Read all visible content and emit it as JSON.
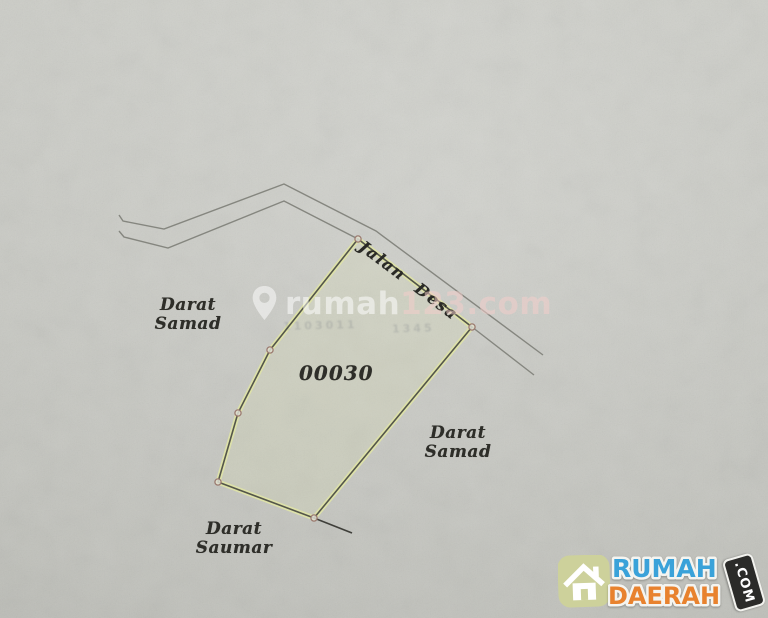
{
  "map": {
    "parcel_number": "00030",
    "road_label": "Jalan Desa",
    "area_labels": {
      "west": {
        "line1": "Darat",
        "line2": "Samad"
      },
      "east": {
        "line1": "Darat",
        "line2": "Samad"
      },
      "south": {
        "line1": "Darat",
        "line2": "Saumar"
      }
    },
    "geometry": {
      "parcel": [
        [
          358,
          239
        ],
        [
          472,
          327
        ],
        [
          314,
          518
        ],
        [
          218,
          482
        ],
        [
          238,
          413
        ],
        [
          270,
          350
        ]
      ],
      "road_upper": [
        [
          119,
          215
        ],
        [
          123,
          221
        ],
        [
          164,
          229
        ],
        [
          284,
          184
        ],
        [
          376,
          231
        ],
        [
          543,
          355
        ]
      ],
      "road_lower": [
        [
          119,
          231
        ],
        [
          124,
          237
        ],
        [
          168,
          248
        ],
        [
          284,
          201
        ],
        [
          358,
          239
        ],
        [
          472,
          327
        ],
        [
          534,
          375
        ]
      ],
      "extension": [
        [
          314,
          518
        ],
        [
          352,
          533
        ]
      ],
      "vertices": [
        [
          358,
          239
        ],
        [
          472,
          327
        ],
        [
          314,
          518
        ],
        [
          218,
          482
        ],
        [
          238,
          413
        ],
        [
          270,
          350
        ]
      ]
    },
    "colors": {
      "paper": "#cdcec8",
      "parcel_outline": "#54564a",
      "parcel_highlight": "#dde1a9",
      "parcel_fill": "rgba(222,226,170,0.18)",
      "road_line": "#85867f",
      "extension_line": "#3f3f3a",
      "vertex_ring": "#9b7a6f",
      "vertex_fill": "rgba(222,222,212,0.85)",
      "label_ink": "#2e2e29"
    }
  },
  "watermark": {
    "pin_icon": "map-pin-icon",
    "prefix": "rumah",
    "suffix": "123.com"
  },
  "bleedthrough": {
    "left": "1103011",
    "right": "1345"
  },
  "logo": {
    "line1": "RUMAH",
    "line2": "DAERAH",
    "badge": ".COM",
    "colors": {
      "line1": "#3aa2d9",
      "line2": "#e8822e",
      "badge_bg": "#2b2b29",
      "house_bg": "#cdd19b"
    }
  }
}
